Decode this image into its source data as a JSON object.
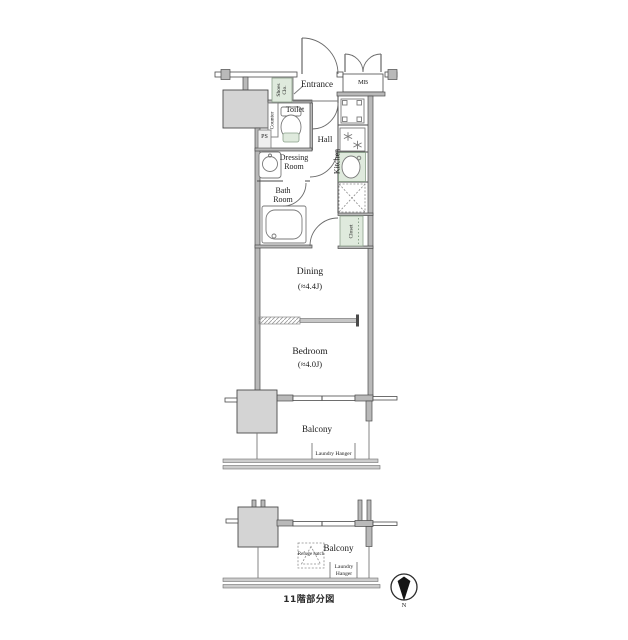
{
  "colors": {
    "wall_stroke": "#4a4a4a",
    "wall_fill": "#b9b9b9",
    "pillar_fill": "#d4d4d4",
    "fixture_green": "#dfeadd",
    "fixture_border": "#8ba18b",
    "text": "#1c1c1c"
  },
  "upper_plan": {
    "entrance": "Entrance",
    "meter_box": "MB",
    "shoes_closet": "Shoes Clo.",
    "counter": "Counter",
    "toilet": "Toilet",
    "pipe_space": "PS",
    "hall": "Hall",
    "kitchen": "Kitchen",
    "dressing_room": "Dressing Room",
    "bath_room": "Bath Room",
    "closet": "Closet",
    "dining": {
      "label": "Dining",
      "size": "(≈4.4J)"
    },
    "bedroom": {
      "label": "Bedroom",
      "size": "(≈4.0J)"
    },
    "balcony": "Balcony",
    "laundry_hanger": "Laundry Hanger"
  },
  "lower_plan": {
    "balcony": "Balcony",
    "laundry_hanger": "Laundry Hanger",
    "refuge_hatch": "Refuge hatch",
    "caption": "11階部分図"
  },
  "compass": {
    "north": "N"
  }
}
